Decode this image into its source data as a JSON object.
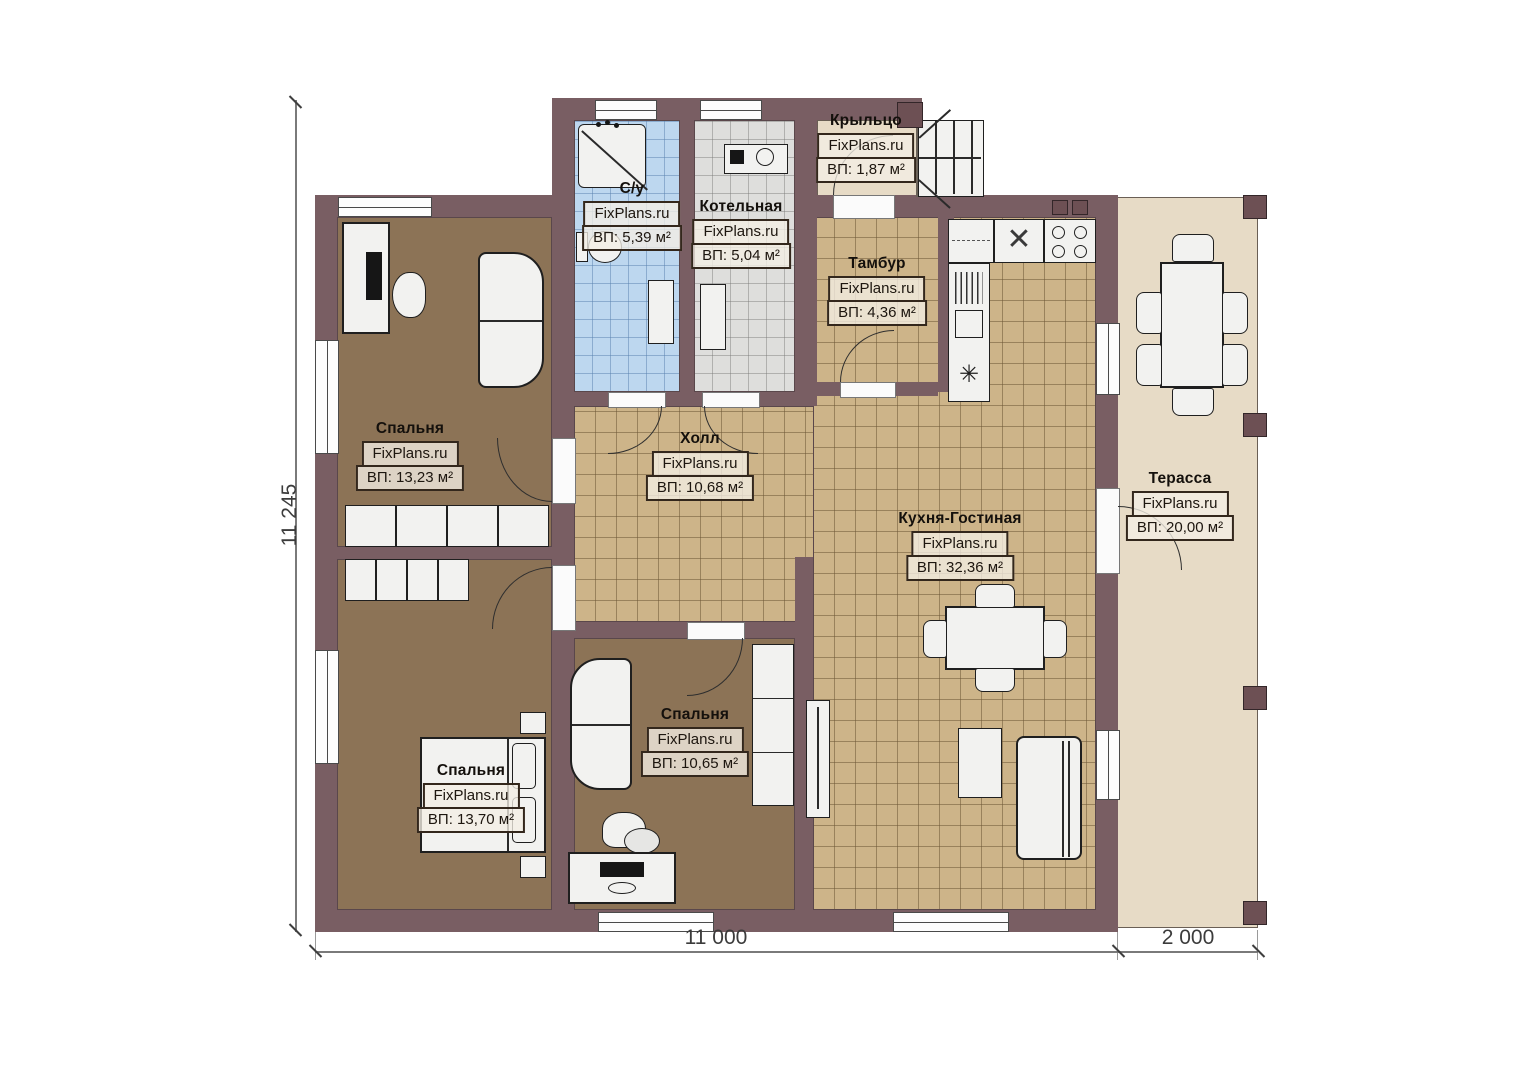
{
  "watermark": "FixPlans.ru",
  "dimensions": {
    "left_height": "11 245",
    "bottom_main": "11 000",
    "bottom_terrace": "2 000"
  },
  "rooms": [
    {
      "id": "bathroom",
      "name": "С/у",
      "area": "ВП: 5,39 м²"
    },
    {
      "id": "boiler-room",
      "name": "Котельная",
      "area": "ВП: 5,04 м²"
    },
    {
      "id": "porch",
      "name": "Крыльцо",
      "area": "ВП: 1,87 м²"
    },
    {
      "id": "vestibule",
      "name": "Тамбур",
      "area": "ВП: 4,36 м²"
    },
    {
      "id": "hall",
      "name": "Холл",
      "area": "ВП: 10,68 м²"
    },
    {
      "id": "kitchen-living",
      "name": "Кухня-Гостиная",
      "area": "ВП: 32,36 м²"
    },
    {
      "id": "terrace",
      "name": "Терасса",
      "area": "ВП: 20,00 м²"
    },
    {
      "id": "bedroom-1",
      "name": "Спальня",
      "area": "ВП: 13,23 м²"
    },
    {
      "id": "bedroom-2",
      "name": "Спальня",
      "area": "ВП: 13,70 м²"
    },
    {
      "id": "bedroom-3",
      "name": "Спальня",
      "area": "ВП: 10,65 м²"
    }
  ],
  "icons": {
    "boiler_symbol": "✳",
    "casework_x": "✕"
  },
  "colors": {
    "wall": "#795e63",
    "bedroom_floor": "#8c7356",
    "tile_floor": "#cdb489",
    "bathroom_tile": "#bdd7ef",
    "boiler_tile": "#dededc",
    "terrace_floor": "#e7dbc6",
    "furniture": "#f2f2f0",
    "label_border": "#33271c"
  }
}
